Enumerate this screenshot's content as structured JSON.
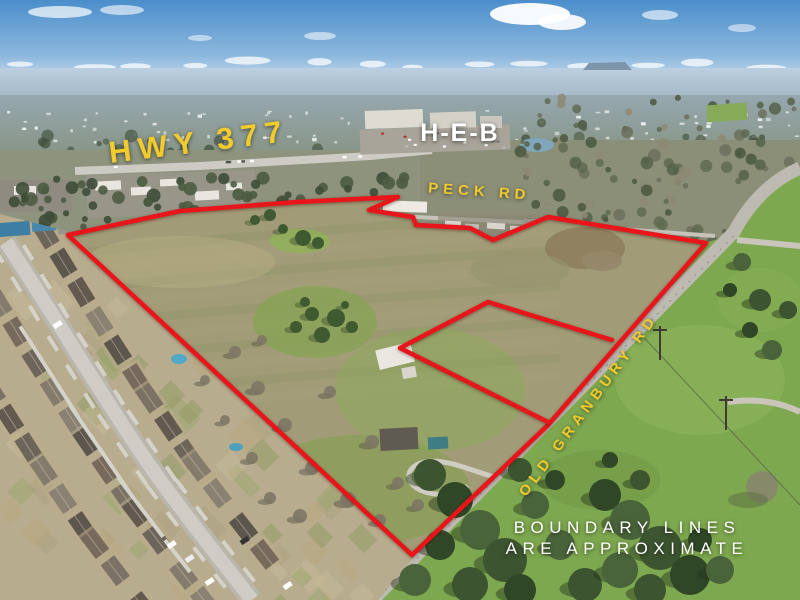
{
  "photo": {
    "type": "aerial-listing-photo",
    "labels": {
      "highway": {
        "text": "HWY 377",
        "color": "#f2cb2c"
      },
      "store": {
        "text": "H-E-B",
        "color": "#ffffff"
      },
      "peck_road": {
        "text": "PECK RD",
        "color": "#f2cb2c"
      },
      "old_granbury_road": {
        "text": "OLD GRANBURY RD",
        "color": "#f2cb2c"
      },
      "disclaimer": {
        "line1": "BOUNDARY LINES",
        "line2": "ARE APPROXIMATE",
        "color": "#ffffff"
      }
    },
    "boundary": {
      "color": "#e8151a",
      "main_points": "68,235 180,211 297,202 398,197 369,210 413,217 416,225 470,228 493,240 548,217 706,243 548,425 412,555",
      "cutout_points": "612,340 488,302 400,348 548,422"
    }
  }
}
